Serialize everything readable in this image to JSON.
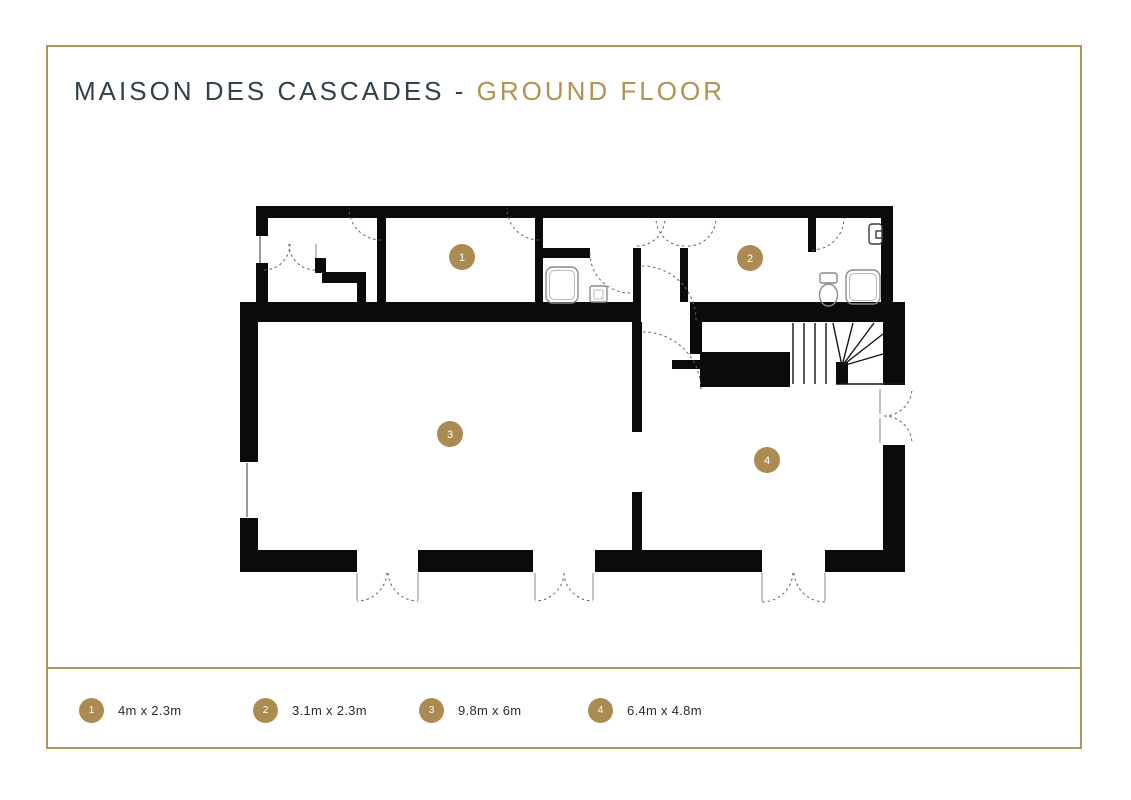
{
  "title": {
    "main": "MAISON DES CASCADES -",
    "accent": "GROUND FLOOR"
  },
  "rooms": [
    {
      "number": "1",
      "label": "4m x 2.3m"
    },
    {
      "number": "2",
      "label": "3.1m x 2.3m"
    },
    {
      "number": "3",
      "label": "9.8m x 6m"
    },
    {
      "number": "4",
      "label": "6.4m x 4.8m"
    }
  ],
  "colors": {
    "gold_accent": "#b3914f",
    "gold_border": "#b2955c",
    "marker_gold": "#ab8b52",
    "title_dark": "#31424b",
    "wall_black": "#0b0b0b"
  }
}
